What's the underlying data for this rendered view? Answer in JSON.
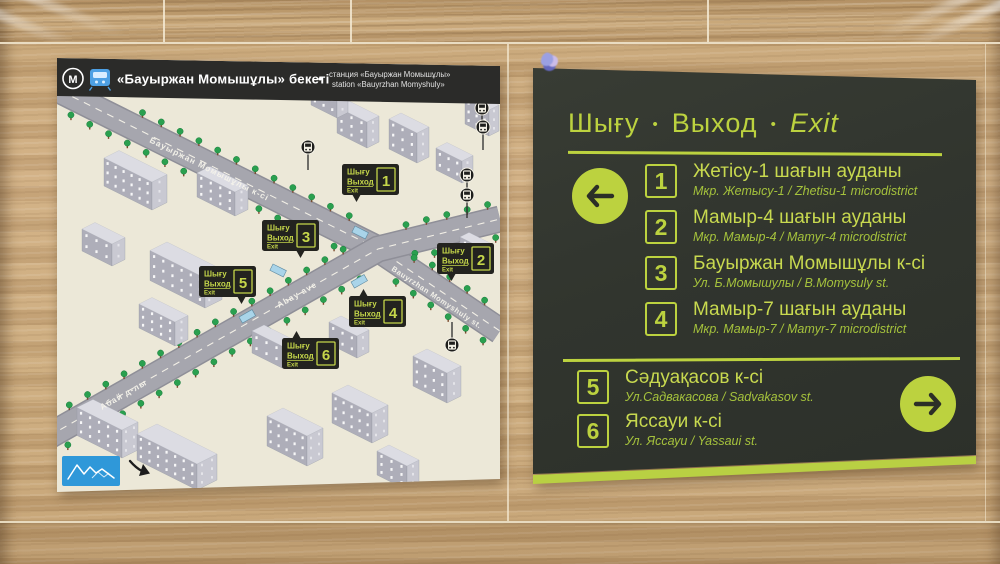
{
  "map_sign": {
    "header": {
      "metro_symbol": "M",
      "title": "«Бауыржан Момышұлы» бекеті",
      "dot": "•",
      "subtitle_ru": "станция «Бауыржан Момышұлы»",
      "subtitle_en": "station «Bauyrzhan Momyshuly»"
    },
    "streets": {
      "momyshuly_kk": "Бауыржан Момышұлы к-сі",
      "momyshuly_en": "Bauyrzhan Momyshuly st.",
      "abay_en": "Abay ave",
      "abay_kk": "Абай д-лы"
    },
    "badge_labels": {
      "kk": "Шығу",
      "ru": "Выход",
      "en": "Exit"
    },
    "badges": [
      {
        "number": "1"
      },
      {
        "number": "2"
      },
      {
        "number": "3"
      },
      {
        "number": "4"
      },
      {
        "number": "5"
      },
      {
        "number": "6"
      }
    ]
  },
  "exit_sign": {
    "header": {
      "kk": "Шығу",
      "ru": "Выход",
      "en": "Exit",
      "dot": "•"
    },
    "groups": [
      {
        "direction": "left",
        "items": [
          {
            "num": "1",
            "title": "Жетісу-1 шағын ауданы",
            "subtitle": "Мкр. Жетысу-1 / Zhetisu-1 microdistrict"
          },
          {
            "num": "2",
            "title": "Мамыр-4 шағын ауданы",
            "subtitle": "Мкр. Мамыр-4 / Mamyr-4 microdistrict"
          },
          {
            "num": "3",
            "title": "Бауыржан Момышұлы к-сі",
            "subtitle": "Ул. Б.Момышулы / B.Momysuly st."
          },
          {
            "num": "4",
            "title": "Мамыр-7 шағын ауданы",
            "subtitle": "Мкр. Мамыр-7 / Mamyr-7 microdistrict"
          }
        ]
      },
      {
        "direction": "right",
        "items": [
          {
            "num": "5",
            "title": "Сәдуақасов к-сі",
            "subtitle": "Ул.Садвакасова / Sadvakasov st."
          },
          {
            "num": "6",
            "title": "Яссауи к-сі",
            "subtitle": "Ул. Яссауи / Yassaui st."
          }
        ]
      }
    ]
  },
  "colors": {
    "accent_green": "#b9d043",
    "panel_dark": "#31352e",
    "badge_dark": "#23231f",
    "map_paper": "#ece8d8",
    "map_header_dark": "#2b2b29",
    "road_gray": "#a3a3ab",
    "tree_green": "#2aa04f",
    "logo_blue": "#2f98d9",
    "train_blue": "#4da0e4",
    "wall_tan": "#c6a376"
  }
}
